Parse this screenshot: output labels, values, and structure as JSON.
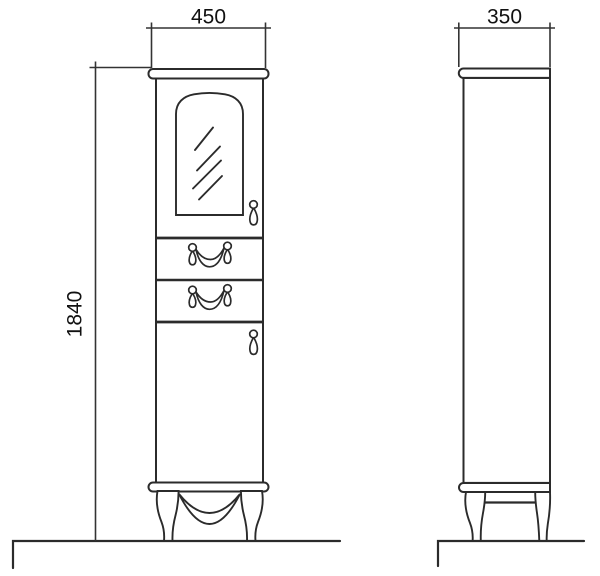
{
  "drawing": {
    "type": "furniture technical drawing, tall cabinet front and side elevation",
    "front_view": {
      "width_label": "450",
      "height_label": "1840"
    },
    "side_view": {
      "depth_label": "350"
    },
    "colors": {
      "line": "#2b2b2b",
      "dimension_line": "#333333",
      "text": "#111111",
      "background": "#ffffff"
    }
  }
}
